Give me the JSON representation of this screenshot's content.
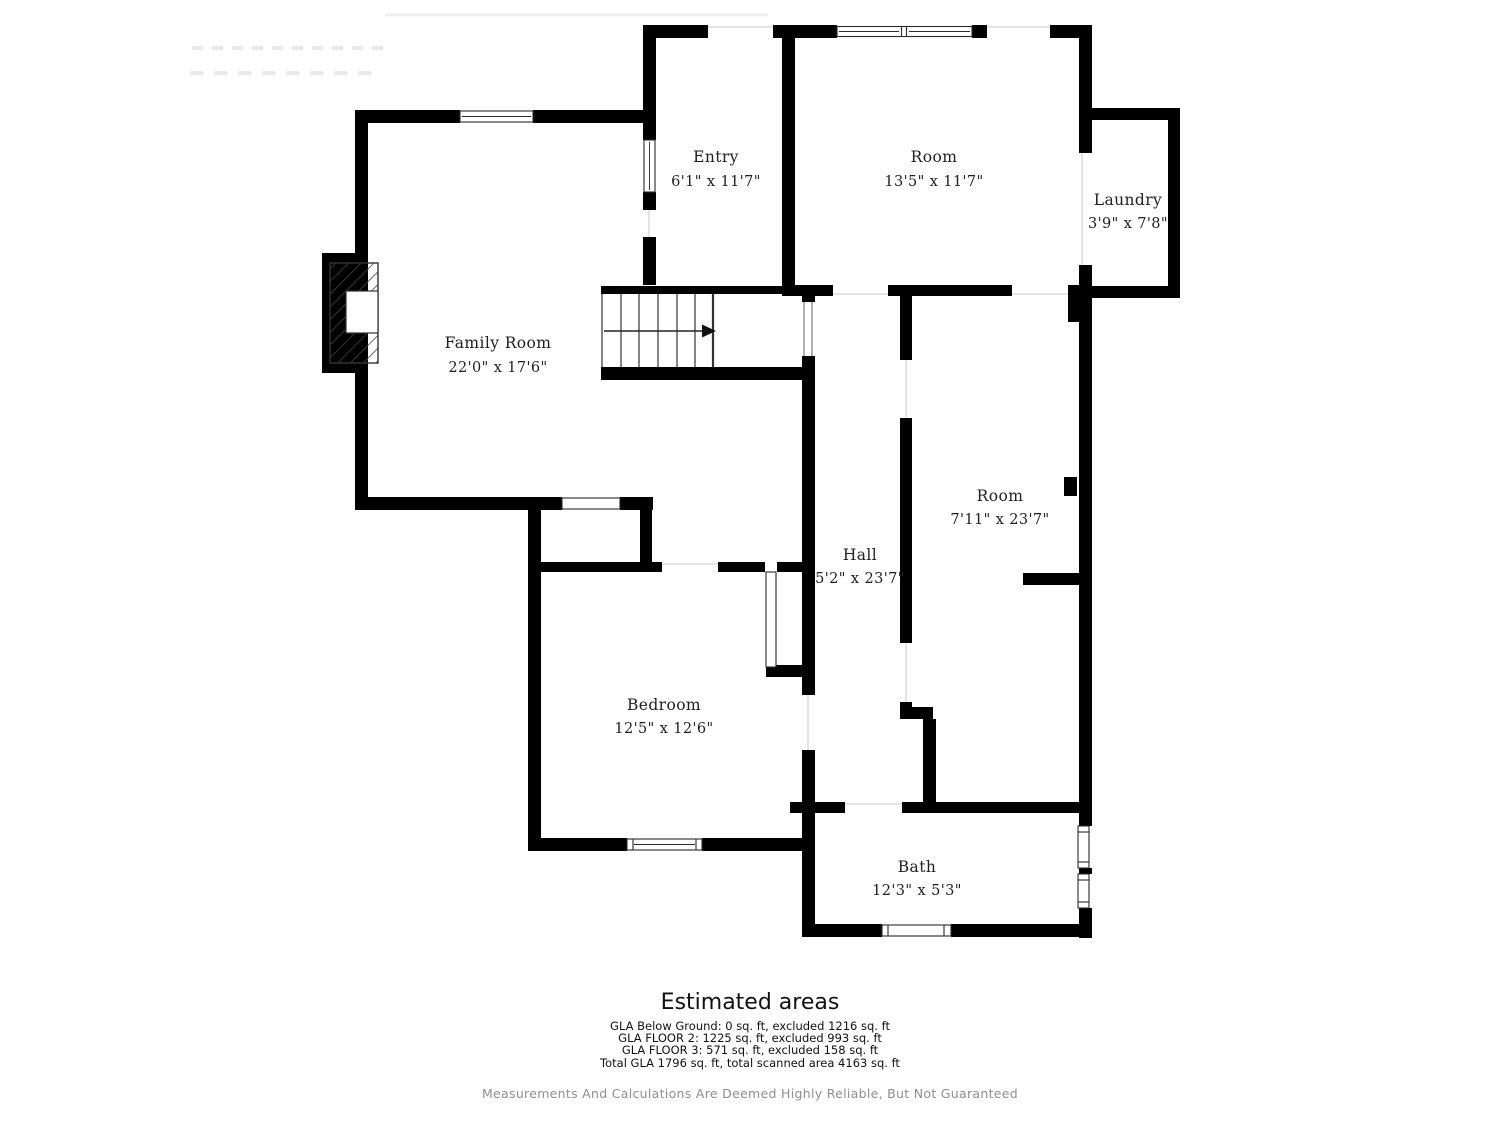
{
  "plan": {
    "rooms": [
      {
        "name": "Entry",
        "dims": "6'1\" x 11'7\""
      },
      {
        "name": "Room",
        "dims": "13'5\" x 11'7\""
      },
      {
        "name": "Laundry",
        "dims": "3'9\" x 7'8\""
      },
      {
        "name": "Family Room",
        "dims": "22'0\" x 17'6\""
      },
      {
        "name": "Hall",
        "dims": "5'2\" x 23'7\""
      },
      {
        "name": "Room",
        "dims": "7'11\" x 23'7\""
      },
      {
        "name": "Bedroom",
        "dims": "12'5\" x 12'6\""
      },
      {
        "name": "Bath",
        "dims": "12'3\" x 5'3\""
      }
    ],
    "stairs": {
      "direction": "right",
      "steps": 7
    }
  },
  "areas": {
    "title": "Estimated areas",
    "lines": [
      "GLA Below Ground: 0 sq. ft, excluded 1216 sq. ft",
      "GLA FLOOR 2: 1225 sq. ft, excluded 993 sq. ft",
      "GLA FLOOR 3: 571 sq. ft, excluded 158 sq. ft",
      "Total GLA 1796 sq. ft, total scanned area 4163 sq. ft"
    ],
    "disclaimer": "Measurements And Calculations Are Deemed Highly Reliable, But Not Guaranteed"
  },
  "colors": {
    "wall": "#000000",
    "label": "#1f1f1f",
    "disclaimer": "#8f8f8f"
  }
}
